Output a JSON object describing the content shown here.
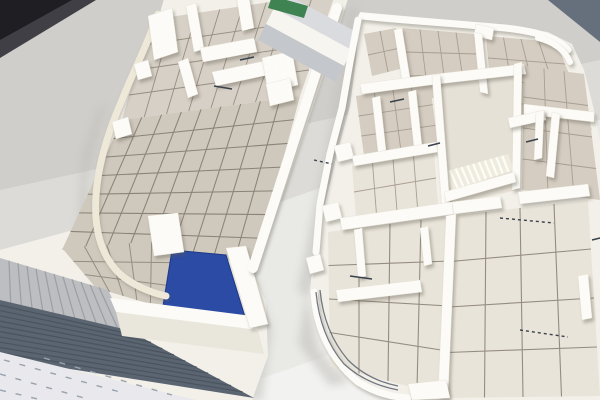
{
  "image": {
    "kind": "photograph",
    "subject": "Two white architectural scale models of building floor plans standing on a light table",
    "left_model": {
      "name": "left floor-plan model",
      "features": "tiled grid floor, room partition walls, curved cream perimeter wall, blue pool basin, striped gray ramp, dark corrugated strip, pale dashed road strip, green board edge, gray walkway panels"
    },
    "right_model": {
      "name": "right floor-plan model",
      "features": "tiled grid floors, many partition walls, central staircase, rounded corner walls, dark door tick marks"
    }
  },
  "colors": {
    "table_base": "#dcdbd7",
    "table_shade": "#c3c2be",
    "backdrop_dark": "#1f1e23",
    "backdrop_gray": "#403f45",
    "backdrop_blue_gray": "#66707c",
    "model_base": "#f2f0e9",
    "wall_white": "#fcfbf7",
    "wall_bright": "#fffef9",
    "wall_shade": "#e9e6dc",
    "wall_cream": "#eee8d8",
    "floor_tan": "#cfc8bd",
    "floor_tan_light": "#d7d0c6",
    "floor_beige": "#d5cdc1",
    "floor_cream": "#e9e4d9",
    "floor_pale": "#e6e1d6",
    "grid_dark": "#8b8378",
    "grid_mid": "#968e82",
    "grid_soft": "#a89f92",
    "grid_sparse": "#948c80",
    "pool_blue": "#2b4ba4",
    "pool_edge": "#1d3a85",
    "ramp_gray": "#bcbec1",
    "ramp_stripe": "#9c9ea2",
    "water_dark": "#5b6571",
    "water_ridge": "#4a545e",
    "road_pale": "#e8e8ed",
    "road_dash": "#9aa2ac",
    "panel_gray": "#c4c7cc",
    "panel_light": "#d9dbde",
    "panel_white": "#f7f5f0",
    "green_accent": "#3f8352",
    "stair_tread": "#efecdf",
    "stair_edge": "#fdfdf7",
    "trim_dark": "#707781",
    "tick_dark": "#39414d",
    "shadow": "#c0bfbb"
  }
}
